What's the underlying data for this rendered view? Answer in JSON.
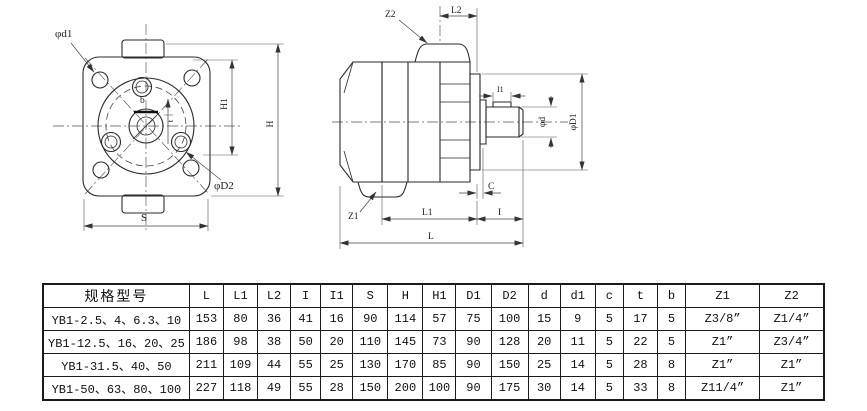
{
  "labels": {
    "phi_d1": "φd1",
    "phi_D2": "φD2",
    "b": "b",
    "t": "t",
    "H1": "H1",
    "H": "H",
    "S": "S",
    "Z2": "Z2",
    "L2": "L2",
    "I1": "I1",
    "phi_d": "φd",
    "phi_D1": "φD1",
    "C": "C",
    "Z1": "Z1",
    "L1": "L1",
    "I": "I",
    "L": "L"
  },
  "table": {
    "headers": [
      "规格型号",
      "L",
      "L1",
      "L2",
      "I",
      "I1",
      "S",
      "H",
      "H1",
      "D1",
      "D2",
      "d",
      "d1",
      "c",
      "t",
      "b",
      "Z1",
      "Z2"
    ],
    "rows": [
      [
        "YB1-2.5、4、6.3、10",
        "153",
        "80",
        "36",
        "41",
        "16",
        "90",
        "114",
        "57",
        "75",
        "100",
        "15",
        "9",
        "5",
        "17",
        "5",
        "Z3/8”",
        "Z1/4”"
      ],
      [
        "YB1-12.5、16、20、25",
        "186",
        "98",
        "38",
        "50",
        "20",
        "110",
        "145",
        "73",
        "90",
        "128",
        "20",
        "11",
        "5",
        "22",
        "5",
        "Z1”",
        "Z3/4”"
      ],
      [
        "YB1-31.5、40、50",
        "211",
        "109",
        "44",
        "55",
        "25",
        "130",
        "170",
        "85",
        "90",
        "150",
        "25",
        "14",
        "5",
        "28",
        "8",
        "Z1”",
        "Z1”"
      ],
      [
        "YB1-50、63、80、100",
        "227",
        "118",
        "49",
        "55",
        "28",
        "150",
        "200",
        "100",
        "90",
        "175",
        "30",
        "14",
        "5",
        "33",
        "8",
        "Z11/4”",
        "Z1”"
      ]
    ]
  }
}
